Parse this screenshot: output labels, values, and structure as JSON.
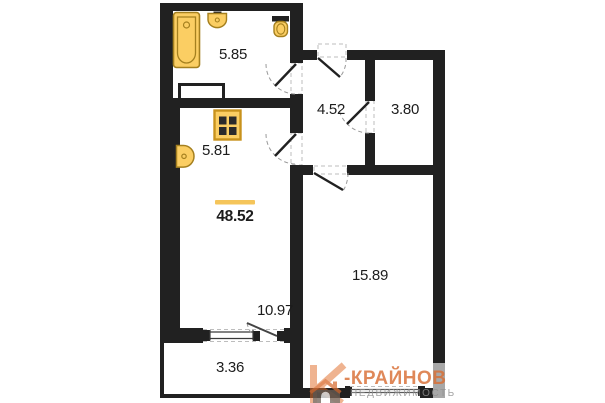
{
  "plan": {
    "rooms": {
      "bathroom": {
        "area": "5.85"
      },
      "hallway": {
        "area": "4.52"
      },
      "storage": {
        "area": "3.80"
      },
      "kitchen": {
        "area": "5.81"
      },
      "living_room": {
        "area": "10.97"
      },
      "bedroom": {
        "area": "15.89"
      },
      "balcony": {
        "area": "3.36"
      }
    },
    "total_area": "48.52"
  },
  "watermark": {
    "brand": "-КРАЙНОВ",
    "subtitle": "НЕДВИЖИМОСТЬ"
  },
  "icons": {
    "fixtures": [
      "bathtub-icon",
      "sink-icon",
      "toilet-icon",
      "stove-icon",
      "kitchen-sink-icon"
    ],
    "logo": "brand-logo-icon"
  },
  "colors": {
    "wall": "#212121",
    "fixture_fill": "#fbce63",
    "fixture_stroke": "#a5801f",
    "total_underline": "#f5c55a",
    "brand_orange": "#d96f35",
    "brand_gray": "#8f8f8f",
    "window_gray": "#a8a8a8"
  }
}
